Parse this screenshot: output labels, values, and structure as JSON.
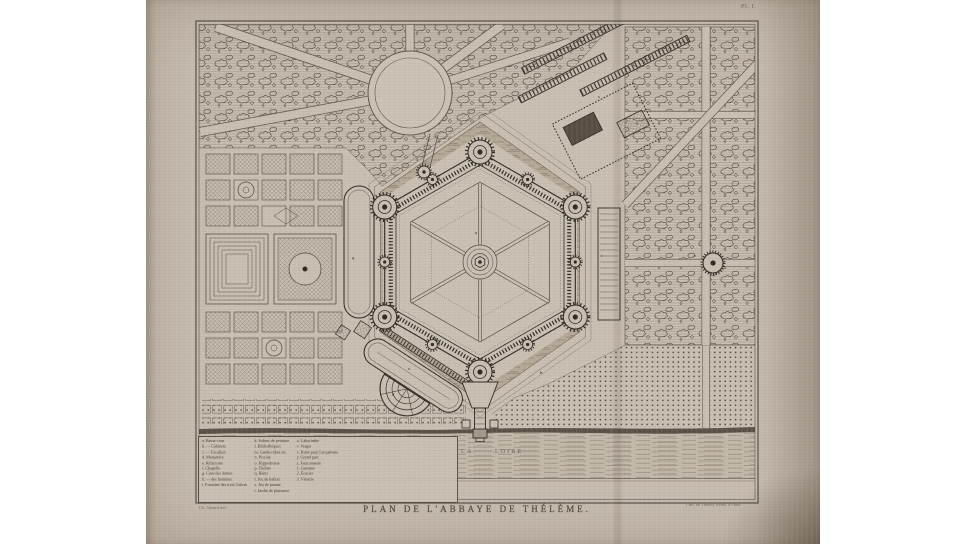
{
  "plate": {
    "plate_number": "Pl. I.",
    "title": "PLAN DE L'ABBAYE DE THÉLÈME.",
    "credit_left": "Ch. Gérard del.",
    "credit_right": "Lith. de Thierry frères, à Paris.",
    "river": {
      "label_la": "LA",
      "label_loire": "LOIRE"
    },
    "colors": {
      "paper": "#c8beb1",
      "ink": "#2e2923",
      "moat_wash": "#b1a595",
      "margin": "#ffffff"
    }
  },
  "legend": {
    "col1": [
      "a. Basse-cour",
      "b. — Cabinets",
      "c. — Escaliers",
      "d. Monastère",
      "e. Réfectoire",
      "f. Chapelle",
      "g. Cour des dames",
      "h. — des hommes",
      "i. Fontaine des trois Grâces"
    ],
    "col2": [
      "k. Salons de peinture",
      "l. Bibliothèques",
      "m. Garde-robes etc.",
      "n. Piscine",
      "o. Hippodrome",
      "p. Théâtre",
      "q. Bains",
      "r. Jeu de ballon",
      "s. Jeu de paume",
      "t. Jardin de plaisance"
    ],
    "col3": [
      "u. Labyrinthe",
      "v. Verger",
      "x. Butte pour l'arquebuse",
      "y. Grand parc",
      "z. Fauconnerie",
      "1. Garenne",
      "2. Écuries",
      "3. Vénerie"
    ]
  },
  "plan_labels": {
    "a": "a",
    "b": "b",
    "q": "q",
    "t": "t",
    "v": "v",
    "r": "r",
    "s": "s",
    "o": "o",
    "p": "p"
  }
}
